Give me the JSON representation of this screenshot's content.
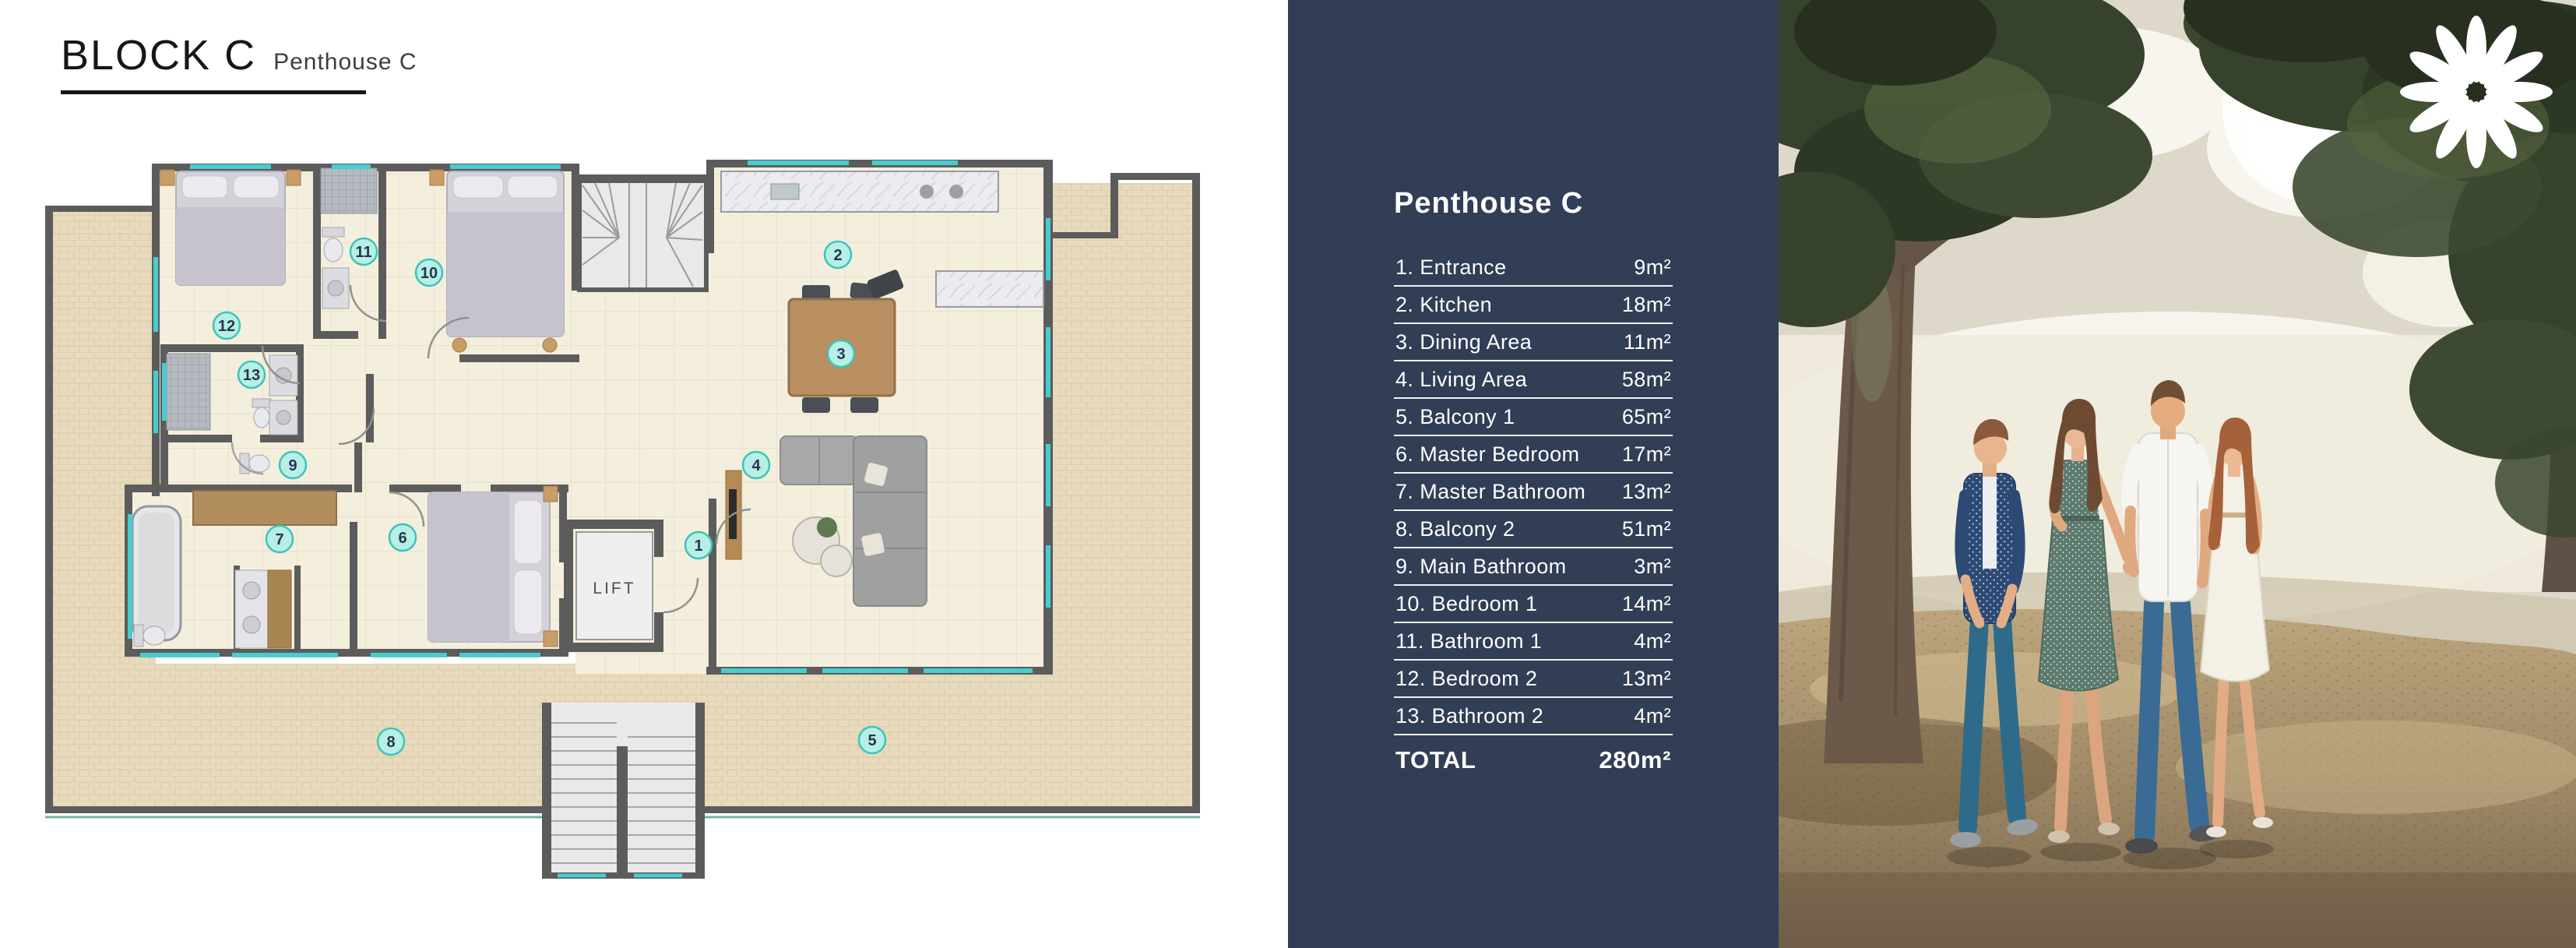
{
  "header": {
    "title": "BLOCK C",
    "subtitle": "Penthouse C"
  },
  "panel": {
    "heading": "Penthouse C",
    "rows": [
      {
        "label": "1. Entrance",
        "value": "9m²"
      },
      {
        "label": "2. Kitchen",
        "value": "18m²"
      },
      {
        "label": "3. Dining Area",
        "value": "11m²"
      },
      {
        "label": "4. Living Area",
        "value": "58m²"
      },
      {
        "label": "5. Balcony 1",
        "value": "65m²"
      },
      {
        "label": "6. Master Bedroom",
        "value": "17m²"
      },
      {
        "label": "7. Master Bathroom",
        "value": "13m²"
      },
      {
        "label": "8. Balcony 2",
        "value": "51m²"
      },
      {
        "label": "9. Main Bathroom",
        "value": "3m²"
      },
      {
        "label": "10. Bedroom 1",
        "value": "14m²"
      },
      {
        "label": "11. Bathroom 1",
        "value": "4m²"
      },
      {
        "label": "12. Bedroom 2",
        "value": "13m²"
      },
      {
        "label": "13. Bathroom 2",
        "value": "4m²"
      }
    ],
    "total": {
      "label": "TOTAL",
      "value": "280m²"
    }
  },
  "plan": {
    "lift_label": "LIFT",
    "markers": [
      "1",
      "2",
      "3",
      "4",
      "5",
      "6",
      "7",
      "8",
      "9",
      "10",
      "11",
      "12",
      "13"
    ]
  },
  "colors": {
    "panel_bg": "#323d56",
    "wall_gray": "#5c5c5c",
    "floor_cream": "#f4eedd",
    "tile_beige": "#e8dabd",
    "window_teal": "#47ccd1",
    "marker_fill": "#b7efe6",
    "marker_ring": "#3cc4b8",
    "logo_white": "#ffffff"
  }
}
